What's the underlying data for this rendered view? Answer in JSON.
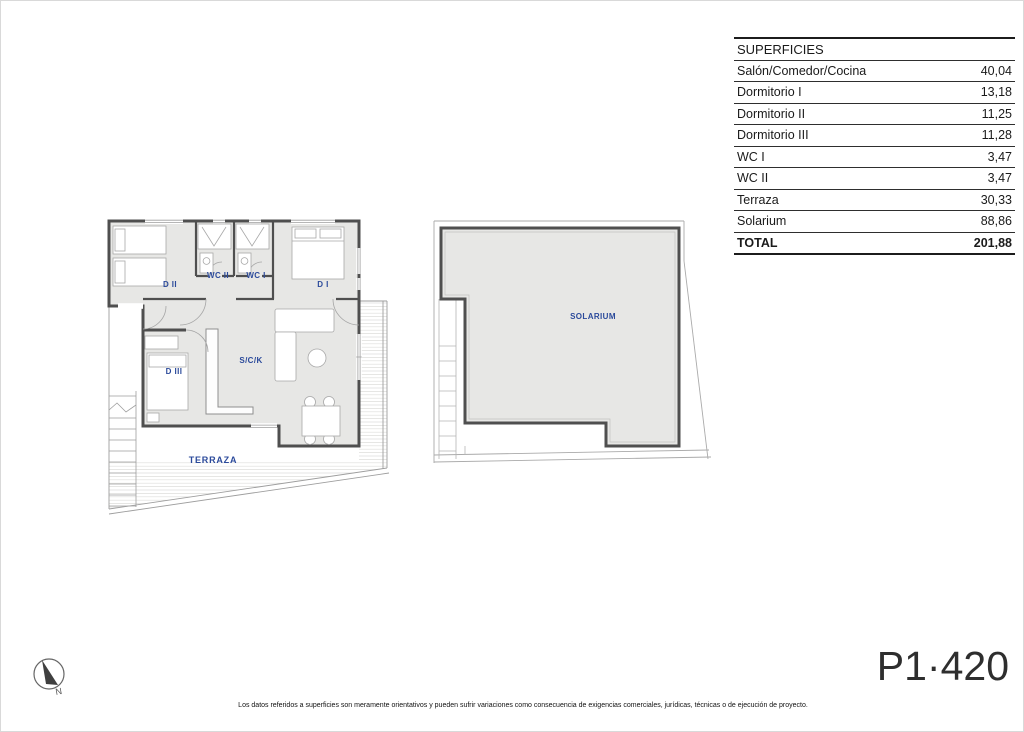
{
  "table": {
    "title": "SUPERFICIES",
    "rows": [
      {
        "label": "Salón/Comedor/Cocina",
        "value": "40,04"
      },
      {
        "label": "Dormitorio I",
        "value": "13,18"
      },
      {
        "label": "Dormitorio II",
        "value": "11,25"
      },
      {
        "label": "Dormitorio III",
        "value": "11,28"
      },
      {
        "label": "WC I",
        "value": "3,47"
      },
      {
        "label": "WC II",
        "value": "3,47"
      },
      {
        "label": "Terraza",
        "value": "30,33"
      },
      {
        "label": "Solarium",
        "value": "88,86"
      }
    ],
    "total": {
      "label": "TOTAL",
      "value": "201,88"
    }
  },
  "floorplan": {
    "rooms": {
      "d1": "D I",
      "d2": "D II",
      "d3": "D III",
      "wc1": "WC I",
      "wc2": "WC II",
      "sck": "S/C/K",
      "terraza": "TERRAZA"
    }
  },
  "solarium_plan": {
    "label": "SOLARIUM"
  },
  "compass": {
    "label": "N"
  },
  "plan_code": "P1·420",
  "footer": {
    "disclaimer": "Los datos referidos a superficies son meramente orientativos y pueden sufrir variaciones como consecuencia de exigencias comerciales, jurídicas, técnicas o de ejecución de proyecto."
  },
  "colors": {
    "label_blue": "#2b4a9b",
    "floor_gray": "#e7e7e5",
    "wall_gray": "#4f4f4f"
  }
}
